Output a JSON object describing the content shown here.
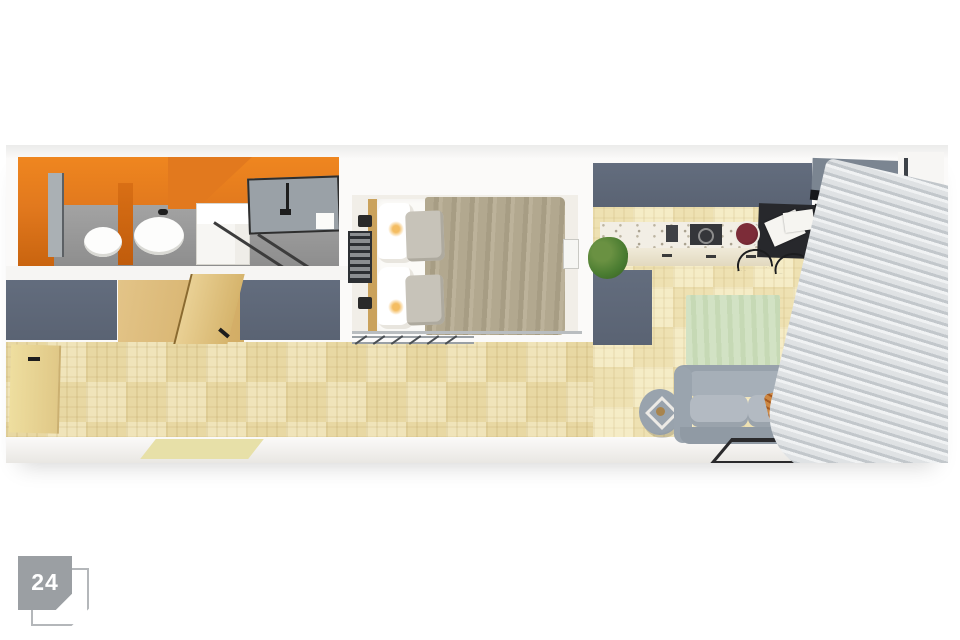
{
  "badge": {
    "number": "24",
    "fill": "#9b9fa3",
    "outline": "#b4b7ba",
    "text_color": "#ffffff"
  },
  "palette": {
    "page_background": "#ffffff",
    "wall_white": "#fbfaf9",
    "wall_slate": "#5a6373",
    "wall_slate_light": "#7b8591",
    "bathroom_orange": "#e2791e",
    "bathroom_floor_gray": "#949494",
    "parquet_hall": "#eddfb0",
    "parquet_living": "#f4eac4",
    "bedroom_floor": "#f1eee8",
    "bed_blanket_taupe": "#aba188",
    "pillow_gray": "#c7c3b9",
    "wood_door": "#d9b878",
    "sofa_gray": "#9aa4ae",
    "rug_green": "#cfdfc1",
    "cushion_orange": "#cd8742",
    "plant_green": "#4a7c31",
    "desk_black": "#27282c",
    "counter_terrazzo": "#f2eee5",
    "blinds_gray": "#ccd1d4",
    "window_frame": "#3d4248"
  },
  "scene": {
    "type": "apartment-floorplan-3d-top-view",
    "rooms": [
      {
        "name": "bathroom",
        "features": [
          "orange walls",
          "gray tile floor",
          "toilet",
          "bidet",
          "white vanity cabinet",
          "mirrors",
          "glass shower partition",
          "black fixtures"
        ]
      },
      {
        "name": "hallway",
        "features": [
          "parquet basketweave floor",
          "open wooden doors",
          "slate wardrobe walls",
          "doormat"
        ]
      },
      {
        "name": "bedroom",
        "features": [
          "double bed",
          "white linen",
          "taupe blanket",
          "two gray pillows",
          "wood headboard",
          "wall sconces",
          "window grille",
          "glass partition",
          "clothes rail with hangers"
        ]
      },
      {
        "name": "living-kitchen",
        "features": [
          "terrazzo kitchen counter",
          "cooktop",
          "sink",
          "fruit bowl",
          "black corner desk",
          "laptop",
          "papers",
          "bar stools",
          "green rug",
          "gray sofa",
          "orange patterned cushion",
          "round side table",
          "potted plants",
          "black coffee-table frame",
          "gray blinds",
          "tall window"
        ]
      }
    ]
  }
}
